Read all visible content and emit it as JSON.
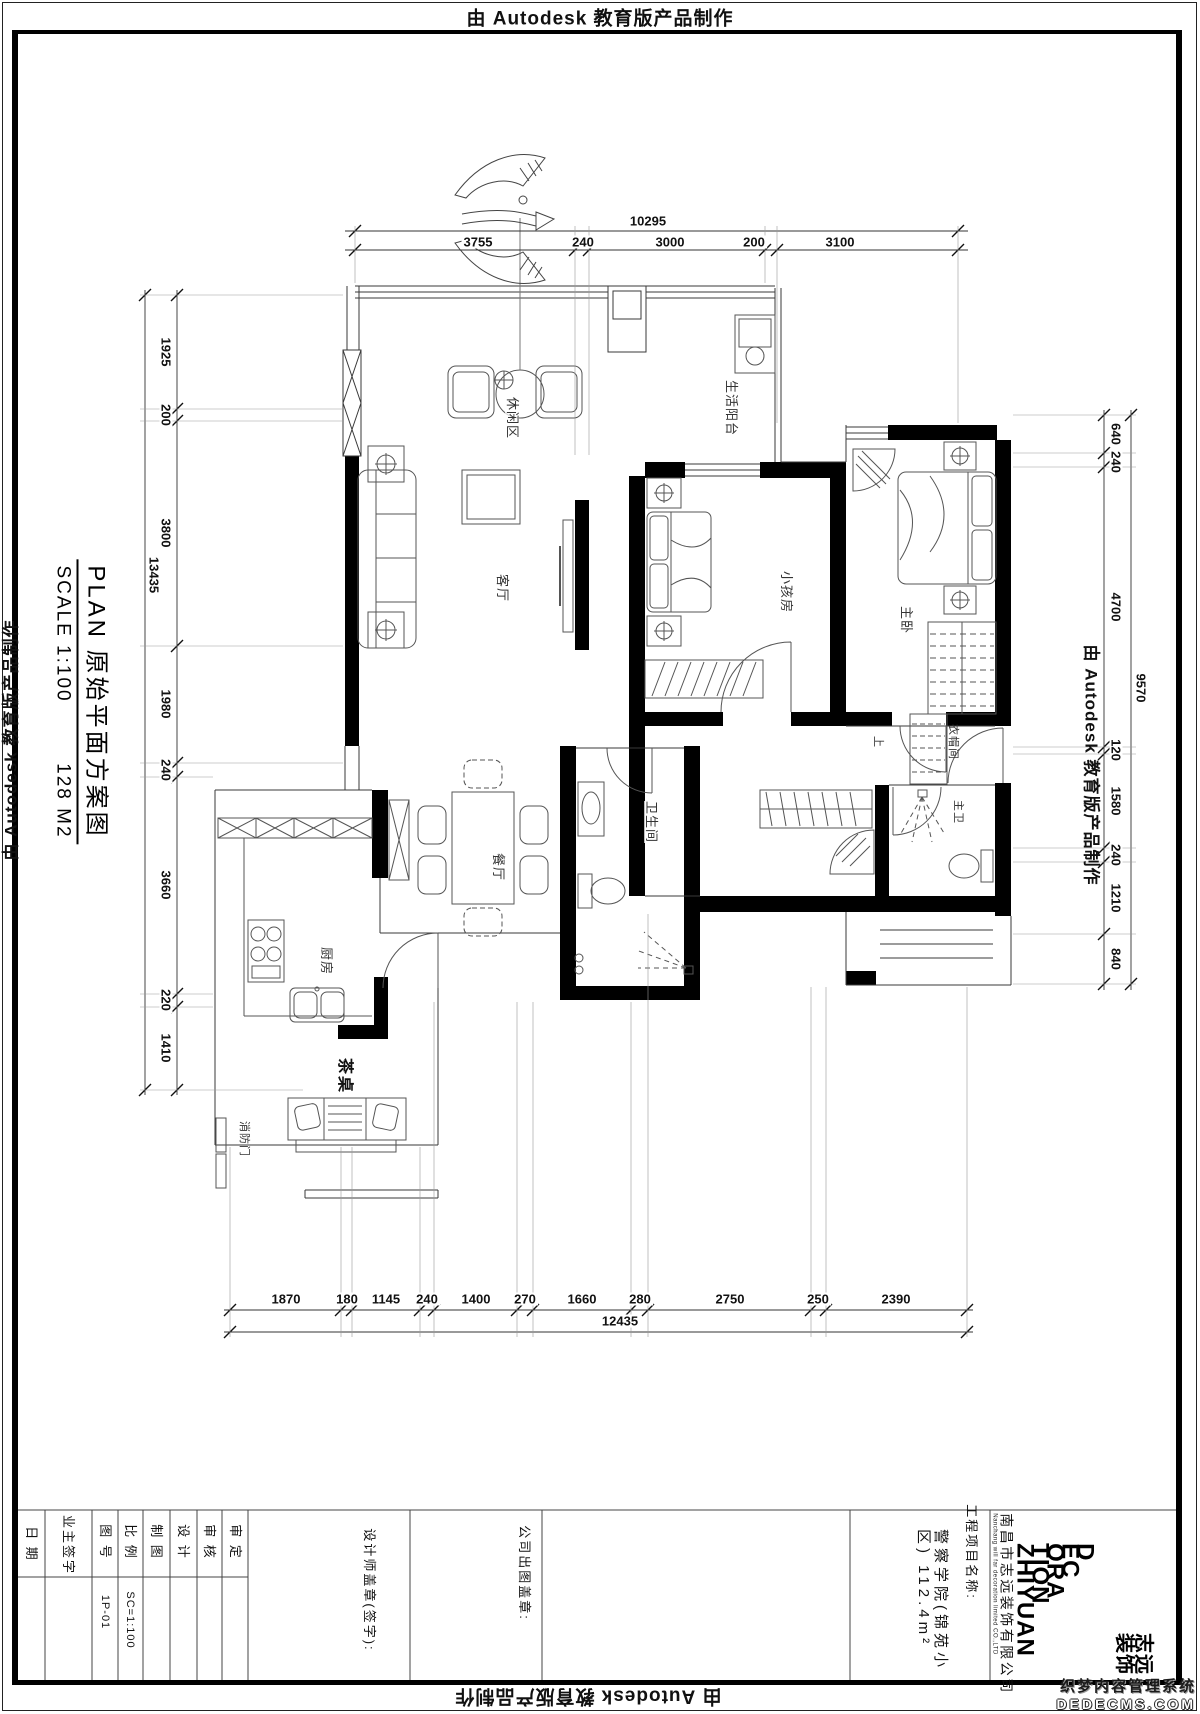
{
  "stamps": {
    "top": "由 Autodesk 教育版产品制作",
    "bottom": "由 Autodesk 教育版产品制作",
    "left": "由 Autodesk 教育版产品制作",
    "right": "由 Autodesk 教育版产品制作"
  },
  "plan_title": {
    "line1": "PLAN  原始平面方案图",
    "scale_label": "SCALE  1:100",
    "area": "128 M2"
  },
  "dims": {
    "top": {
      "overall": "10295",
      "segments": [
        "3755",
        "240",
        "3000",
        "200",
        "3100"
      ]
    },
    "left": {
      "overall": "13435",
      "segments": [
        "1925",
        "200",
        "3800",
        "1980",
        "240",
        "3660",
        "220",
        "1410"
      ]
    },
    "right": {
      "overall": "9570",
      "segments": [
        "640",
        "240",
        "4700",
        "120",
        "1580",
        "240",
        "1210",
        "840"
      ]
    },
    "bottom": {
      "overall": "12435",
      "segments": [
        "1870",
        "180",
        "1145",
        "240",
        "1400",
        "270",
        "1660",
        "280",
        "2750",
        "250",
        "2390"
      ]
    }
  },
  "rooms": {
    "leisure": "休闲区",
    "balcony": "生活阳台",
    "living": "客厅",
    "kids": "小孩房",
    "master": "主卧",
    "cloak": "衣帽间",
    "master_bath": "主卫",
    "bath": "卫生间",
    "dining": "餐厅",
    "kitchen": "厨房",
    "tea_table": "茶桌",
    "fire_door": "消防门",
    "up": "上"
  },
  "titleblock": {
    "date": "日 期",
    "owner_sign": "业主签字",
    "sheet_no_label": "图 号",
    "sheet_no": "1P-01",
    "scale_label": "比 例",
    "scale": "SC=1:100",
    "drafted": "制 图",
    "designed": "设 计",
    "checked": "审 核",
    "approved": "审 定",
    "designer_seal": "设计师盖章(签字):",
    "company_seal": "公司出图盖章:",
    "project_label": "工程项目名称:",
    "project_line1": "警察学院(锦苑小",
    "project_line2": "区)  112.4m²",
    "company_cn": "南昌市志远装饰有限公司",
    "company_en": "Nanchang will far decoration limited CO.,LTD",
    "logo_lines": [
      "D",
      "EC",
      "ORA",
      "TION",
      "ZHIYUAN"
    ],
    "logo_cn_line1": "志远",
    "logo_cn_line2": "装饰"
  },
  "watermark": {
    "line1": "织梦内容管理系统",
    "line2": "DEDECMS.COM"
  }
}
